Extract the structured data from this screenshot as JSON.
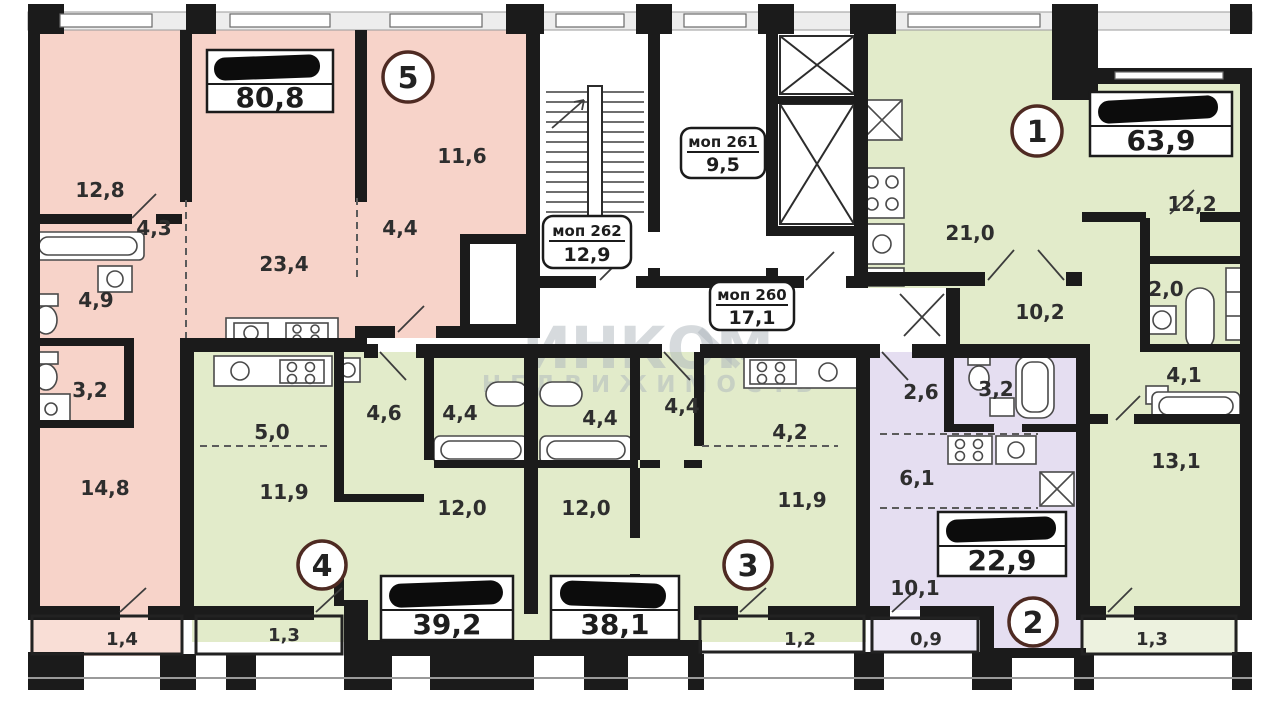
{
  "watermark": {
    "title": "ИНКОМ",
    "subtitle": "НЕДВИЖИМОСТЬ"
  },
  "colors": {
    "pink": "#f7d3c9",
    "green": "#e2ebca",
    "lilac": "#e5def1",
    "lilac_light": "#eee9f6",
    "wall": "#1b1b1b",
    "circle_stroke": "#4e2a22"
  },
  "common": {
    "mop260": {
      "label": "моп 260",
      "area": "17,1"
    },
    "mop261": {
      "label": "моп 261",
      "area": "9,5"
    },
    "mop262": {
      "label": "моп 262",
      "area": "12,9"
    }
  },
  "apt5": {
    "number": "5",
    "total": "80,8",
    "rooms": {
      "bedroom1": "12,8",
      "hall1": "4,3",
      "living": "23,4",
      "bedroom2": "11,6",
      "hall2": "4,4",
      "bath": "4,9",
      "wc": "3,2",
      "bedroom3": "14,8",
      "balcony": "1,4"
    }
  },
  "apt4": {
    "number": "4",
    "total": "39,2",
    "rooms": {
      "kitchen_zone": "5,0",
      "hall": "4,6",
      "bath": "4,4",
      "living": "11,9",
      "bedroom": "12,0",
      "balcony": "1,3"
    }
  },
  "apt3": {
    "number": "3",
    "total": "38,1",
    "rooms": {
      "bath": "4,4",
      "hall": "4,4",
      "bedroom": "12,0",
      "kitchen_zone": "4,2",
      "living": "11,9",
      "balcony": "1,2"
    }
  },
  "apt2": {
    "number": "2",
    "total": "22,9",
    "rooms": {
      "hall": "2,6",
      "bath": "3,2",
      "kitchen_zone": "6,1",
      "living": "10,1",
      "balcony": "0,9"
    }
  },
  "apt1": {
    "number": "1",
    "total": "63,9",
    "rooms": {
      "living": "21,0",
      "bedroom1": "12,2",
      "hall": "10,2",
      "wardrobe": "2,0",
      "bath": "4,1",
      "bedroom2": "13,1",
      "balcony": "1,3"
    }
  }
}
